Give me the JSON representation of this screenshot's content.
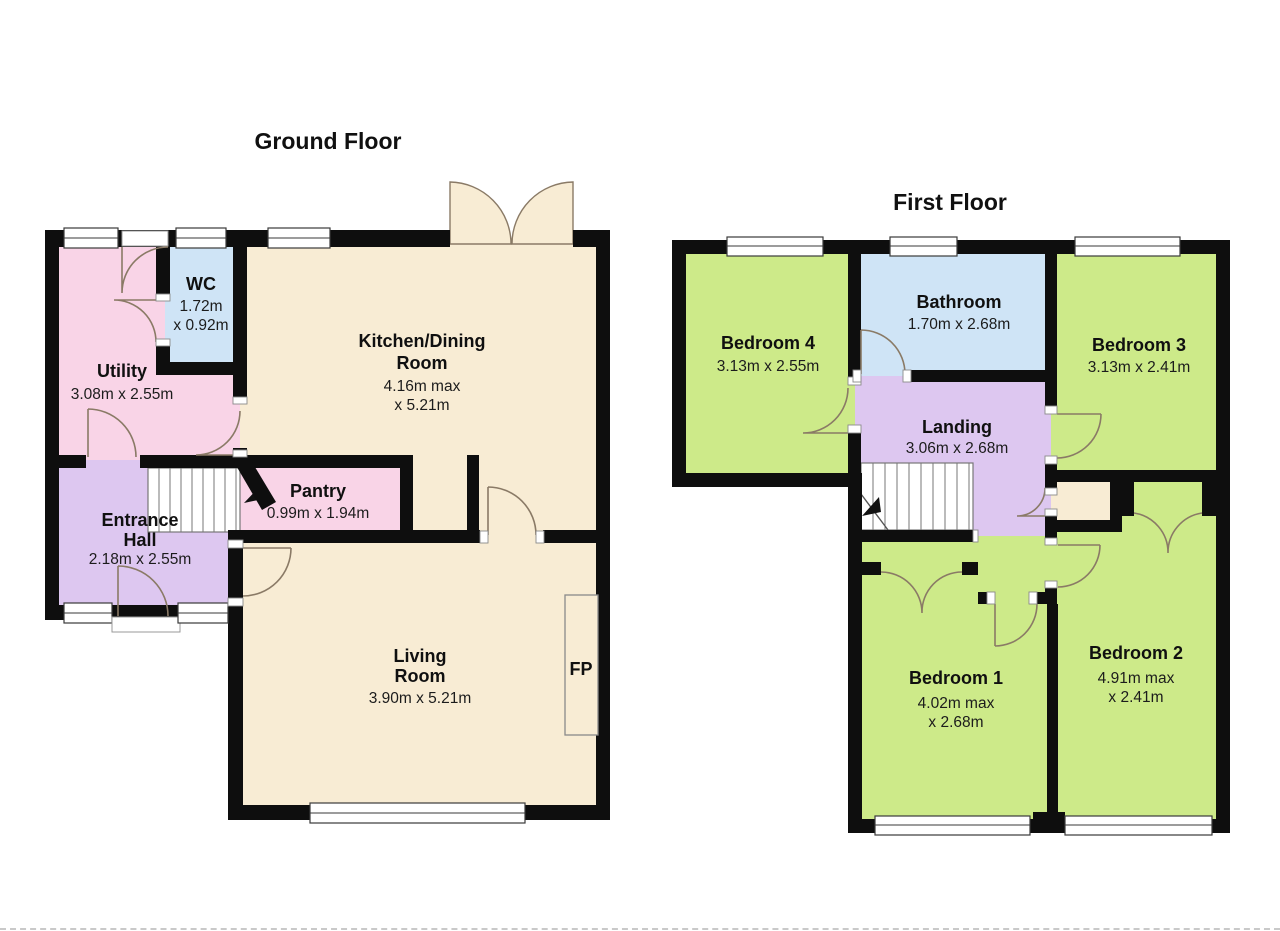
{
  "colors": {
    "wall": "#0e0e0e",
    "room_cream": "#f8ecd4",
    "room_pink": "#f9d4e7",
    "room_blue": "#cfe4f6",
    "room_purple": "#ddc7f0",
    "room_green": "#cdea89"
  },
  "floors": [
    {
      "title": "Ground Floor",
      "rooms": [
        {
          "name": "Utility",
          "dims": "3.08m x 2.55m"
        },
        {
          "name": "WC",
          "dim1": "1.72m",
          "dim2": "x 0.92m"
        },
        {
          "name1": "Kitchen/Dining",
          "name2": "Room",
          "dim1": "4.16m max",
          "dim2": "x 5.21m"
        },
        {
          "name": "Pantry",
          "dims": "0.99m x 1.94m"
        },
        {
          "name1": "Entrance",
          "name2": "Hall",
          "dims": "2.18m x 2.55m"
        },
        {
          "name1": "Living",
          "name2": "Room",
          "dims": "3.90m x 5.21m"
        },
        {
          "name": "FP"
        }
      ]
    },
    {
      "title": "First Floor",
      "rooms": [
        {
          "name": "Bedroom 4",
          "dims": "3.13m x 2.55m"
        },
        {
          "name": "Bathroom",
          "dims": "1.70m x 2.68m"
        },
        {
          "name": "Bedroom 3",
          "dims": "3.13m x 2.41m"
        },
        {
          "name": "Landing",
          "dims": "3.06m x 2.68m"
        },
        {
          "name": "Bedroom 1",
          "dim1": "4.02m max",
          "dim2": "x 2.68m"
        },
        {
          "name": "Bedroom 2",
          "dim1": "4.91m max",
          "dim2": "x 2.41m"
        }
      ]
    }
  ]
}
